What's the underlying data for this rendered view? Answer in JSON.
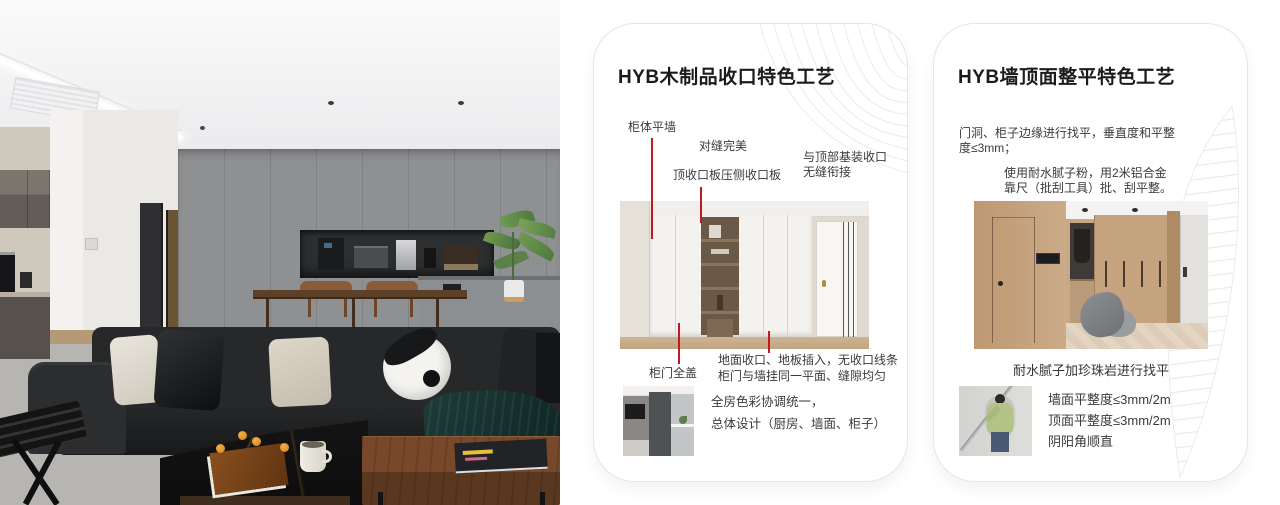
{
  "colors": {
    "leader_red": "#c0191e",
    "card_border": "#e6e6e6",
    "pattern_gray": "#ebebeb"
  },
  "card1": {
    "title": "HYB木制品收口特色工艺",
    "label_cabinet_wall": "柜体平墙",
    "label_seam": "对缝完美",
    "label_top_board": "顶收口板压侧收口板",
    "label_ceiling_join_1": "与顶部基装收口",
    "label_ceiling_join_2": "无缝衔接",
    "label_door_cover": "柜门全盖",
    "label_floor_1": "地面收口、地板插入，无收口线条",
    "label_floor_2": "柜门与墙挂同一平面、缝隙均匀",
    "note_1": "全房色彩协调统一，",
    "note_2": "总体设计（厨房、墙面、柜子）"
  },
  "card2": {
    "title": "HYB墙顶面整平特色工艺",
    "para1_1": "门洞、柜子边缘进行找平，垂直度和平整",
    "para1_2": "度≤3mm；",
    "para2_1": "使用耐水腻子粉，用2米铝合金",
    "para2_2": "靠尺（批刮工具）批、刮平整。",
    "caption": "耐水腻子加珍珠岩进行找平",
    "spec_1": "墙面平整度≤3mm/2m",
    "spec_2": "顶面平整度≤3mm/2m",
    "spec_3": "阴阳角顺直"
  }
}
